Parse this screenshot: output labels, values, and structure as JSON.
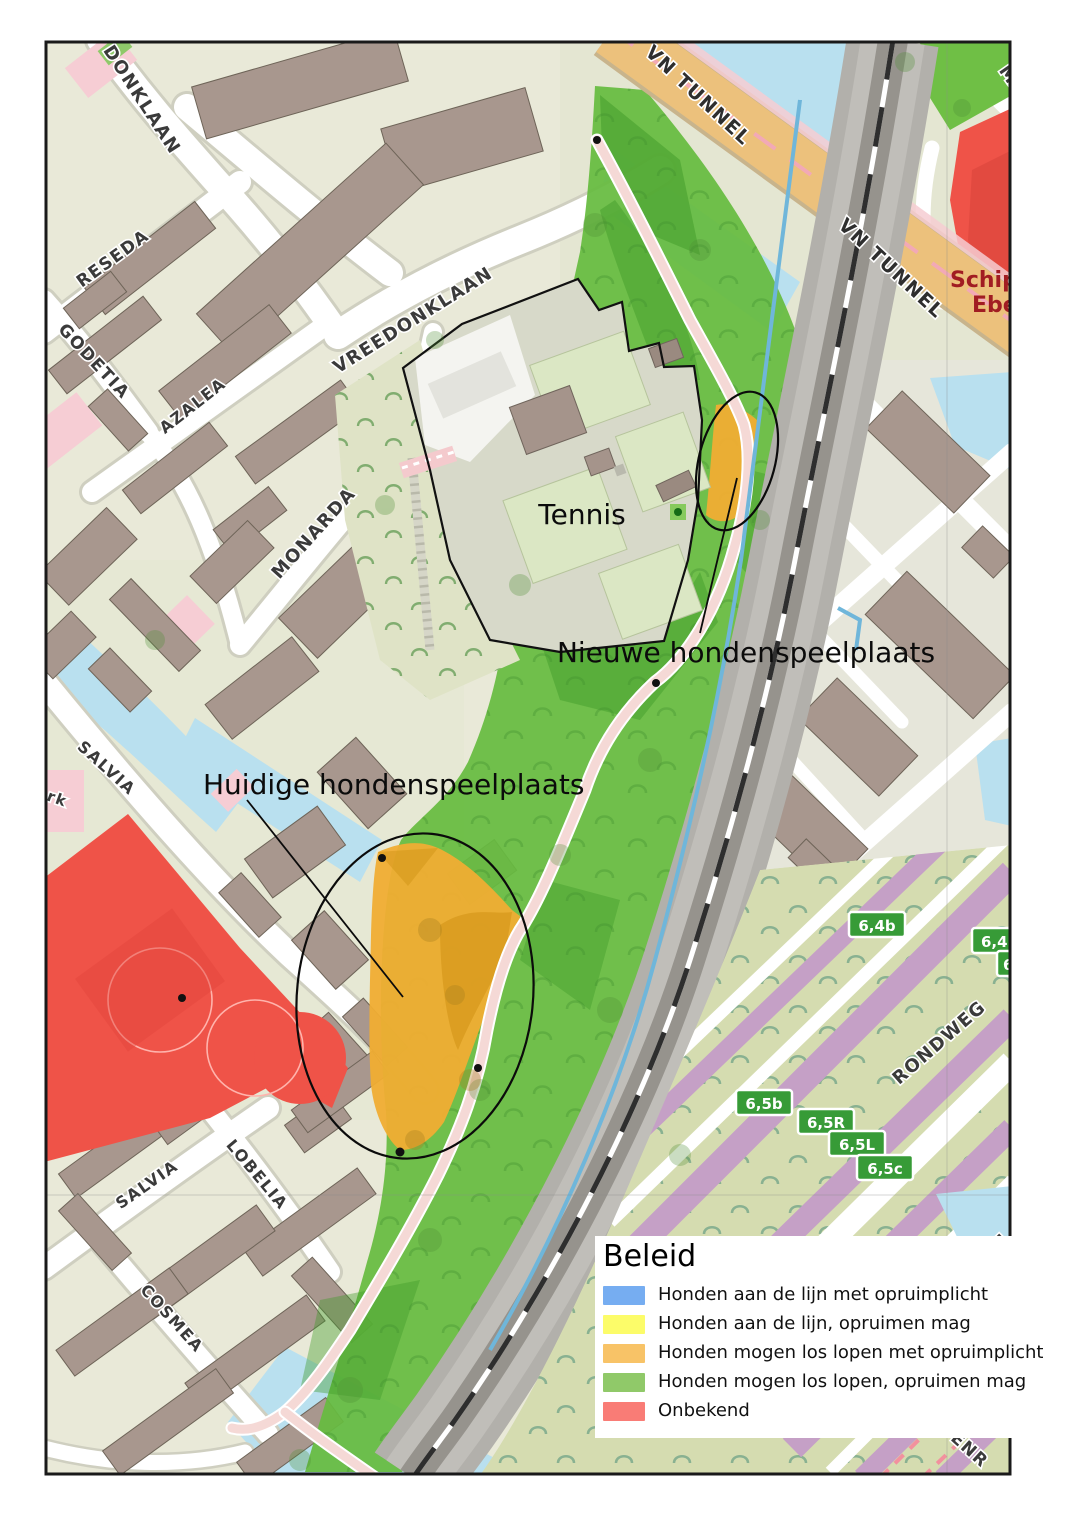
{
  "legend": {
    "title": "Beleid",
    "items": [
      {
        "label": "Honden aan de lijn met opruimplicht",
        "color": "#76adf1"
      },
      {
        "label": "Honden aan de lijn, opruimen mag",
        "color": "#fcfc69"
      },
      {
        "label": "Honden mogen los lopen met opruimplicht",
        "color": "#f8c367"
      },
      {
        "label": "Honden mogen los lopen, opruimen mag",
        "color": "#90c969"
      },
      {
        "label": "Onbekend",
        "color": "#f97c76"
      }
    ]
  },
  "annotations": {
    "tennis": "Tennis",
    "new_area": "Nieuwe hondenspeelplaats",
    "current_area": "Huidige hondenspeelplaats"
  },
  "streets": {
    "donklaan": "DONKLAAN",
    "reseda": "RESEDA",
    "godetia": "GODETIA",
    "azalea": "AZALEA",
    "vreedonklaan": "VREEDONKLAAN",
    "monarda": "MONARDA",
    "salvia_upper": "SALVIA",
    "salvia_lower": "SALVIA",
    "lobelia": "LOBELIA",
    "cosmea": "COSMEA",
    "vn_tunnel_upper": "VN TUNNEL",
    "vn_tunnel_lower": "VN TUNNEL",
    "rondweg": "RONDWEG",
    "ma_partial_top": "MA",
    "ma_partial_bottom": "MA",
    "stenr_partial": "STENR",
    "rk_partial": "rk"
  },
  "places": {
    "schipp_partial_line1": "Schipp",
    "schipp_partial_line2": "Ebe"
  },
  "road_badges": [
    {
      "label": "6,4b"
    },
    {
      "label": "6,4R"
    },
    {
      "label": "6"
    },
    {
      "label": "6,5b"
    },
    {
      "label": "6,5R"
    },
    {
      "label": "6,5L"
    },
    {
      "label": "6,5c"
    }
  ]
}
